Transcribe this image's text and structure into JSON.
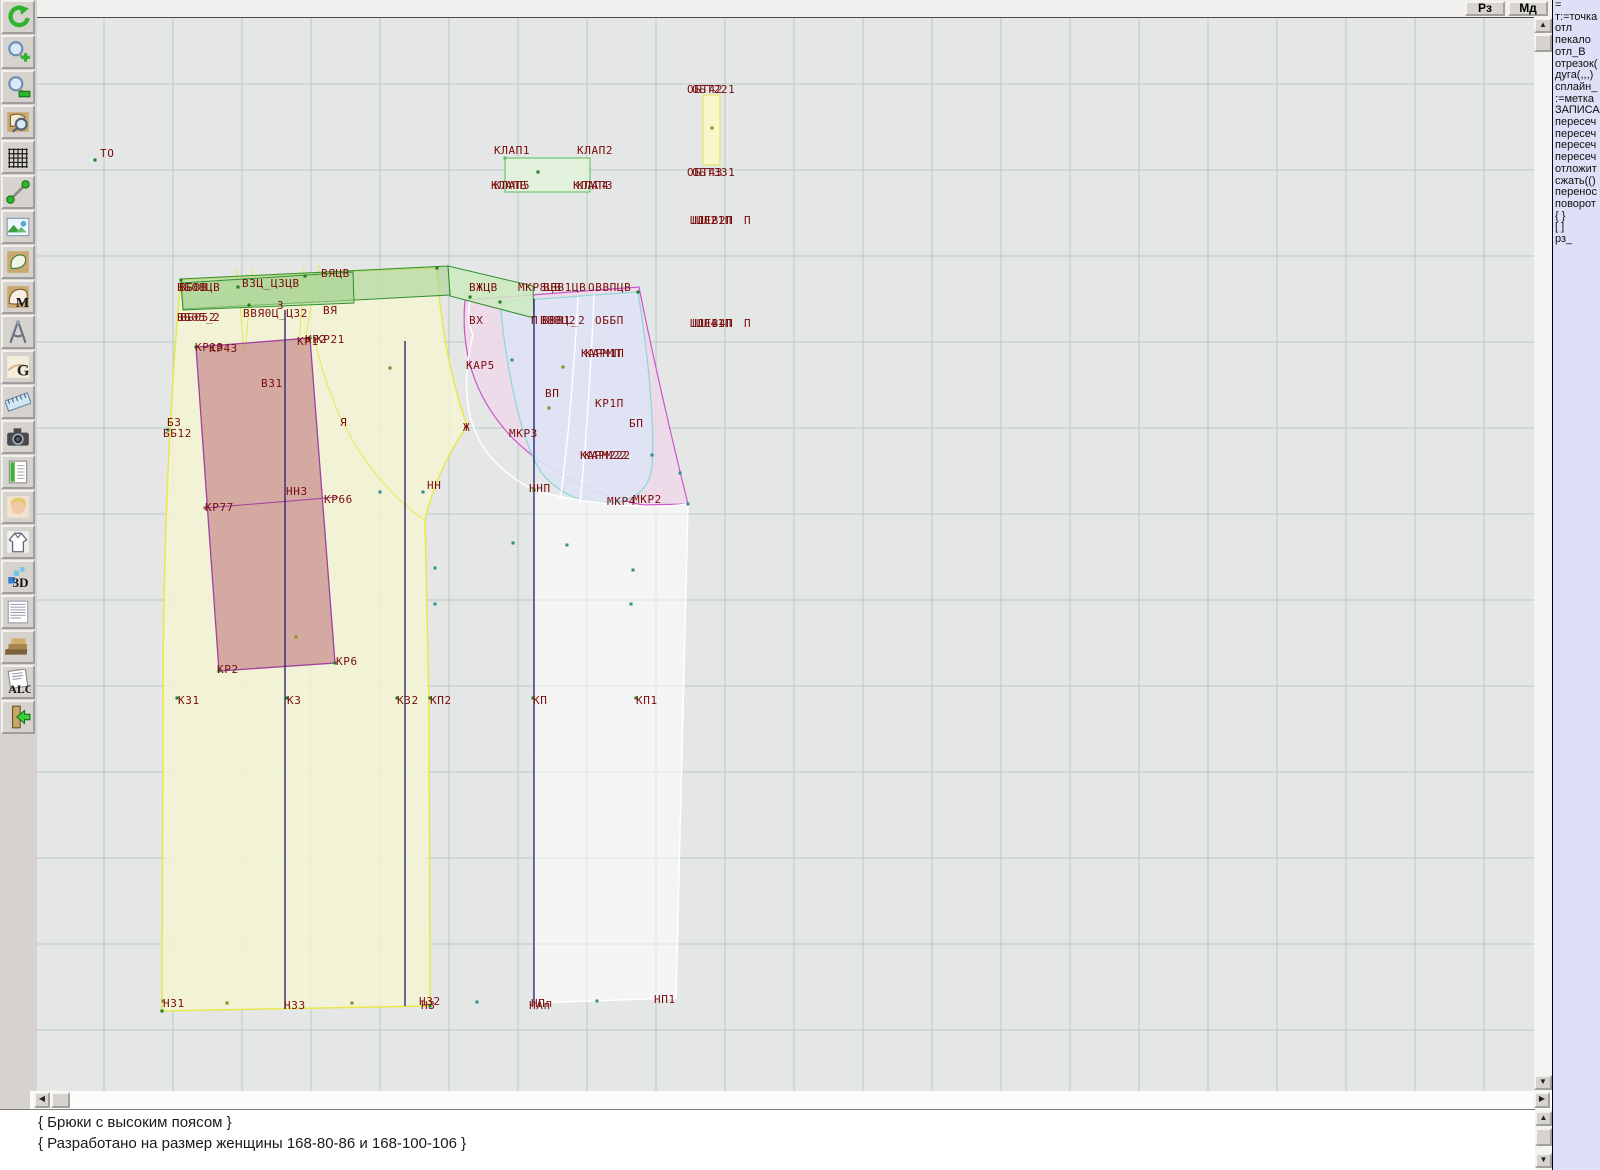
{
  "topbar": {
    "rz_label": "Рз",
    "md_label": "Мд"
  },
  "toolbar": {
    "buttons": [
      "undo",
      "zoom-in",
      "zoom-out",
      "zoom-piece",
      "grid",
      "segment",
      "image",
      "pattern-piece",
      "pattern-m",
      "compass",
      "grazia-g",
      "ruler",
      "camera",
      "table",
      "portrait",
      "garment",
      "3d",
      "text-list",
      "books",
      "alg",
      "exit"
    ],
    "glyphs": {
      "m": "M",
      "g": "G",
      "three_d": "3D",
      "alg": "ALG"
    }
  },
  "command_panel": {
    "items": [
      "=",
      "т:=точка",
      "отл",
      "пекало",
      "отл_В",
      "отрезок(",
      "дуга(,,,)",
      "сплайн_",
      ":=метка",
      "ЗАПИСА",
      "пересеч",
      "пересеч",
      "пересеч",
      "пересеч",
      "отложит",
      "сжать(()",
      "перенос",
      "поворот",
      "{ }",
      "[ ]",
      "рз_"
    ]
  },
  "status_panel": {
    "line1": "{ Брюки с высоким поясом }",
    "line2": "{ Разработано на размер женщины 168-80-86 и 168-100-106 }"
  },
  "scrollbars": {
    "up": "▲",
    "down": "▼",
    "left": "◀",
    "right": "▶"
  },
  "canvas": {
    "colors": {
      "bg": "#e4e7e5",
      "grid": "#b7c9c5",
      "label": "#7a0c0c",
      "back_fill": "#f5f5d2",
      "back_stroke": "#e8e84c",
      "yoke_fill": "#c89090",
      "yoke_stroke": "#a040a0",
      "band_fill": "#a6d392",
      "band_stroke": "#2f8f2f",
      "band_light_fill": "#cdeabf",
      "flap_fill": "#e2f3da",
      "flap_stroke": "#55c055",
      "strip_fill": "#f8f8c6",
      "strip_stroke": "#e3e356",
      "pink_fill": "#f0d8ea",
      "pink_stroke": "#cc55cc",
      "front_fill": "#dee3f4",
      "front_stroke": "#8fd8d8",
      "leg_fill": "#ffffff",
      "grain": "#2a2a72"
    },
    "labels": [
      {
        "t": "ТО",
        "x": 63,
        "y": 139
      },
      {
        "t": "КЛАП1",
        "x": 457,
        "y": 136
      },
      {
        "t": "КЛАП2",
        "x": 540,
        "y": 136
      },
      {
        "t": "КЛАП5",
        "x": 457,
        "y": 171
      },
      {
        "t": "КЛАПБ",
        "x": 454,
        "y": 171
      },
      {
        "t": "КЛАП3",
        "x": 540,
        "y": 171
      },
      {
        "t": "КЛАП4",
        "x": 536,
        "y": 171
      },
      {
        "t": "ОБТ221",
        "x": 655,
        "y": 75
      },
      {
        "t": "ОБТ42",
        "x": 650,
        "y": 75
      },
      {
        "t": "ОБТ331",
        "x": 655,
        "y": 158
      },
      {
        "t": "ОБТ43",
        "x": 650,
        "y": 158
      },
      {
        "t": "ШЛЕВ2П",
        "x": 653,
        "y": 206
      },
      {
        "t": "ШЛ21П",
        "x": 659,
        "y": 206
      },
      {
        "t": "П",
        "x": 707,
        "y": 206
      },
      {
        "t": "ШЛЕВ4П",
        "x": 653,
        "y": 309
      },
      {
        "t": "ШЛ41П",
        "x": 659,
        "y": 309
      },
      {
        "t": "П",
        "x": 707,
        "y": 309
      },
      {
        "t": "ВБ08ЦВ",
        "x": 140,
        "y": 273
      },
      {
        "t": "ВБ0В",
        "x": 142,
        "y": 273
      },
      {
        "t": "ВЗЦ_ЦЗЦВ",
        "x": 205,
        "y": 269
      },
      {
        "t": "ВЯЦВ",
        "x": 284,
        "y": 259
      },
      {
        "t": "ВБ05_2",
        "x": 140,
        "y": 303
      },
      {
        "t": "ВБ052",
        "x": 143,
        "y": 303
      },
      {
        "t": "ВВЯ0Ц_Ц32",
        "x": 206,
        "y": 299
      },
      {
        "t": "З",
        "x": 240,
        "y": 291
      },
      {
        "t": "ВЯ",
        "x": 286,
        "y": 296
      },
      {
        "t": "ВЖЦВ",
        "x": 432,
        "y": 273
      },
      {
        "t": "МКР8ЦВ",
        "x": 481,
        "y": 273
      },
      {
        "t": "ВВВ1ЦВ",
        "x": 506,
        "y": 273
      },
      {
        "t": "ОВВПЦВ",
        "x": 551,
        "y": 273
      },
      {
        "t": "ВХ",
        "x": 432,
        "y": 306
      },
      {
        "t": "П",
        "x": 494,
        "y": 306
      },
      {
        "t": "ВВВ1_2",
        "x": 505,
        "y": 306
      },
      {
        "t": "ВВВЦ2",
        "x": 503,
        "y": 306
      },
      {
        "t": "ОББП",
        "x": 558,
        "y": 306
      },
      {
        "t": "КАР5",
        "x": 429,
        "y": 351
      },
      {
        "t": "КАРМ1П",
        "x": 544,
        "y": 339
      },
      {
        "t": "КАРМП",
        "x": 548,
        "y": 339
      },
      {
        "t": "ВП",
        "x": 508,
        "y": 379
      },
      {
        "t": "КР1П",
        "x": 558,
        "y": 389
      },
      {
        "t": "БП",
        "x": 592,
        "y": 409
      },
      {
        "t": "МКР3",
        "x": 472,
        "y": 419
      },
      {
        "t": "Ж",
        "x": 426,
        "y": 413
      },
      {
        "t": "КАРМ222",
        "x": 543,
        "y": 441
      },
      {
        "t": "КАРМ22",
        "x": 547,
        "y": 441
      },
      {
        "t": "НН",
        "x": 390,
        "y": 471
      },
      {
        "t": "ННП",
        "x": 492,
        "y": 474
      },
      {
        "t": "МКР4",
        "x": 570,
        "y": 487
      },
      {
        "t": "МКР2",
        "x": 596,
        "y": 485
      },
      {
        "t": "КР1З",
        "x": 158,
        "y": 333
      },
      {
        "t": "КР4З",
        "x": 172,
        "y": 334
      },
      {
        "t": "КР1",
        "x": 260,
        "y": 327
      },
      {
        "t": "КР2",
        "x": 268,
        "y": 325
      },
      {
        "t": "КР21",
        "x": 279,
        "y": 325
      },
      {
        "t": "ВЗ1",
        "x": 224,
        "y": 369
      },
      {
        "t": "БЗ",
        "x": 130,
        "y": 408
      },
      {
        "t": "ББ12",
        "x": 126,
        "y": 419
      },
      {
        "t": "Я",
        "x": 303,
        "y": 408
      },
      {
        "t": "НН3",
        "x": 249,
        "y": 477
      },
      {
        "t": "КР66",
        "x": 287,
        "y": 485
      },
      {
        "t": "КР77",
        "x": 168,
        "y": 493
      },
      {
        "t": "КР2",
        "x": 180,
        "y": 655
      },
      {
        "t": "КР6",
        "x": 299,
        "y": 647
      },
      {
        "t": "КЗ1",
        "x": 141,
        "y": 686
      },
      {
        "t": "КЗ",
        "x": 250,
        "y": 686
      },
      {
        "t": "КЗ2",
        "x": 360,
        "y": 686
      },
      {
        "t": "КП2",
        "x": 393,
        "y": 686
      },
      {
        "t": "КП",
        "x": 496,
        "y": 686
      },
      {
        "t": "КП1",
        "x": 599,
        "y": 686
      },
      {
        "t": "НЗ1",
        "x": 126,
        "y": 989
      },
      {
        "t": "НЗЗ",
        "x": 247,
        "y": 991
      },
      {
        "t": "НЗ2",
        "x": 382,
        "y": 987
      },
      {
        "t": "НЗ",
        "x": 384,
        "y": 991
      },
      {
        "t": "НПп",
        "x": 494,
        "y": 989
      },
      {
        "t": "НАп",
        "x": 492,
        "y": 991
      },
      {
        "t": "НП1",
        "x": 617,
        "y": 985
      }
    ],
    "points": [
      {
        "x": 58,
        "y": 142,
        "c": "#1e7d1e"
      },
      {
        "x": 144,
        "y": 262,
        "c": "#1e7d1e"
      },
      {
        "x": 400,
        "y": 250,
        "c": "#1e7d1e"
      },
      {
        "x": 125,
        "y": 993,
        "c": "#1e7d1e"
      },
      {
        "x": 393,
        "y": 988,
        "c": "#1e7d1e"
      },
      {
        "x": 159,
        "y": 329,
        "c": "#1e7d1e"
      },
      {
        "x": 273,
        "y": 320,
        "c": "#1e7d1e"
      },
      {
        "x": 182,
        "y": 653,
        "c": "#1e7d1e"
      },
      {
        "x": 298,
        "y": 645,
        "c": "#1e7d1e"
      },
      {
        "x": 140,
        "y": 680,
        "c": "#1e7d1e"
      },
      {
        "x": 250,
        "y": 680,
        "c": "#1e7d1e"
      },
      {
        "x": 360,
        "y": 680,
        "c": "#1e7d1e"
      },
      {
        "x": 393,
        "y": 680,
        "c": "#1e7d1e"
      },
      {
        "x": 496,
        "y": 680,
        "c": "#1e7d1e"
      },
      {
        "x": 599,
        "y": 680,
        "c": "#1e7d1e"
      },
      {
        "x": 126,
        "y": 983,
        "c": "#8a8a22"
      },
      {
        "x": 190,
        "y": 985,
        "c": "#8a8a22"
      },
      {
        "x": 315,
        "y": 985,
        "c": "#8a8a22"
      },
      {
        "x": 440,
        "y": 984,
        "c": "#2a8f8f"
      },
      {
        "x": 560,
        "y": 983,
        "c": "#2a8f8f"
      },
      {
        "x": 433,
        "y": 279,
        "c": "#1e7d1e"
      },
      {
        "x": 463,
        "y": 284,
        "c": "#1e7d1e"
      },
      {
        "x": 601,
        "y": 274,
        "c": "#1e7d1e"
      },
      {
        "x": 651,
        "y": 486,
        "c": "#2a8f8f"
      },
      {
        "x": 497,
        "y": 472,
        "c": "#1e7d1e"
      },
      {
        "x": 468,
        "y": 140,
        "c": "#55c055"
      },
      {
        "x": 501,
        "y": 154,
        "c": "#1e7d1e"
      },
      {
        "x": 675,
        "y": 110,
        "c": "#8a8a22"
      },
      {
        "x": 131,
        "y": 412,
        "c": "#2a8f8f"
      },
      {
        "x": 343,
        "y": 474,
        "c": "#2a8f8f"
      },
      {
        "x": 386,
        "y": 474,
        "c": "#2a8f8f"
      },
      {
        "x": 398,
        "y": 550,
        "c": "#2a8f8f"
      },
      {
        "x": 398,
        "y": 586,
        "c": "#2a8f8f"
      },
      {
        "x": 530,
        "y": 527,
        "c": "#2a8f8f"
      },
      {
        "x": 596,
        "y": 552,
        "c": "#2a8f8f"
      },
      {
        "x": 594,
        "y": 586,
        "c": "#2a8f8f"
      },
      {
        "x": 615,
        "y": 437,
        "c": "#2a8f8f"
      },
      {
        "x": 643,
        "y": 455,
        "c": "#2a8f8f"
      },
      {
        "x": 476,
        "y": 525,
        "c": "#2a8f8f"
      },
      {
        "x": 526,
        "y": 349,
        "c": "#8a8a22"
      },
      {
        "x": 353,
        "y": 350,
        "c": "#8a8a22"
      },
      {
        "x": 259,
        "y": 619,
        "c": "#8a8a22"
      },
      {
        "x": 168,
        "y": 490,
        "c": "#8a6a42"
      },
      {
        "x": 475,
        "y": 342,
        "c": "#2a8f8f"
      },
      {
        "x": 512,
        "y": 390,
        "c": "#8a8a22"
      },
      {
        "x": 201,
        "y": 269,
        "c": "#1e7d1e"
      },
      {
        "x": 268,
        "y": 258,
        "c": "#1e7d1e"
      },
      {
        "x": 212,
        "y": 287,
        "c": "#1e7d1e"
      }
    ]
  }
}
